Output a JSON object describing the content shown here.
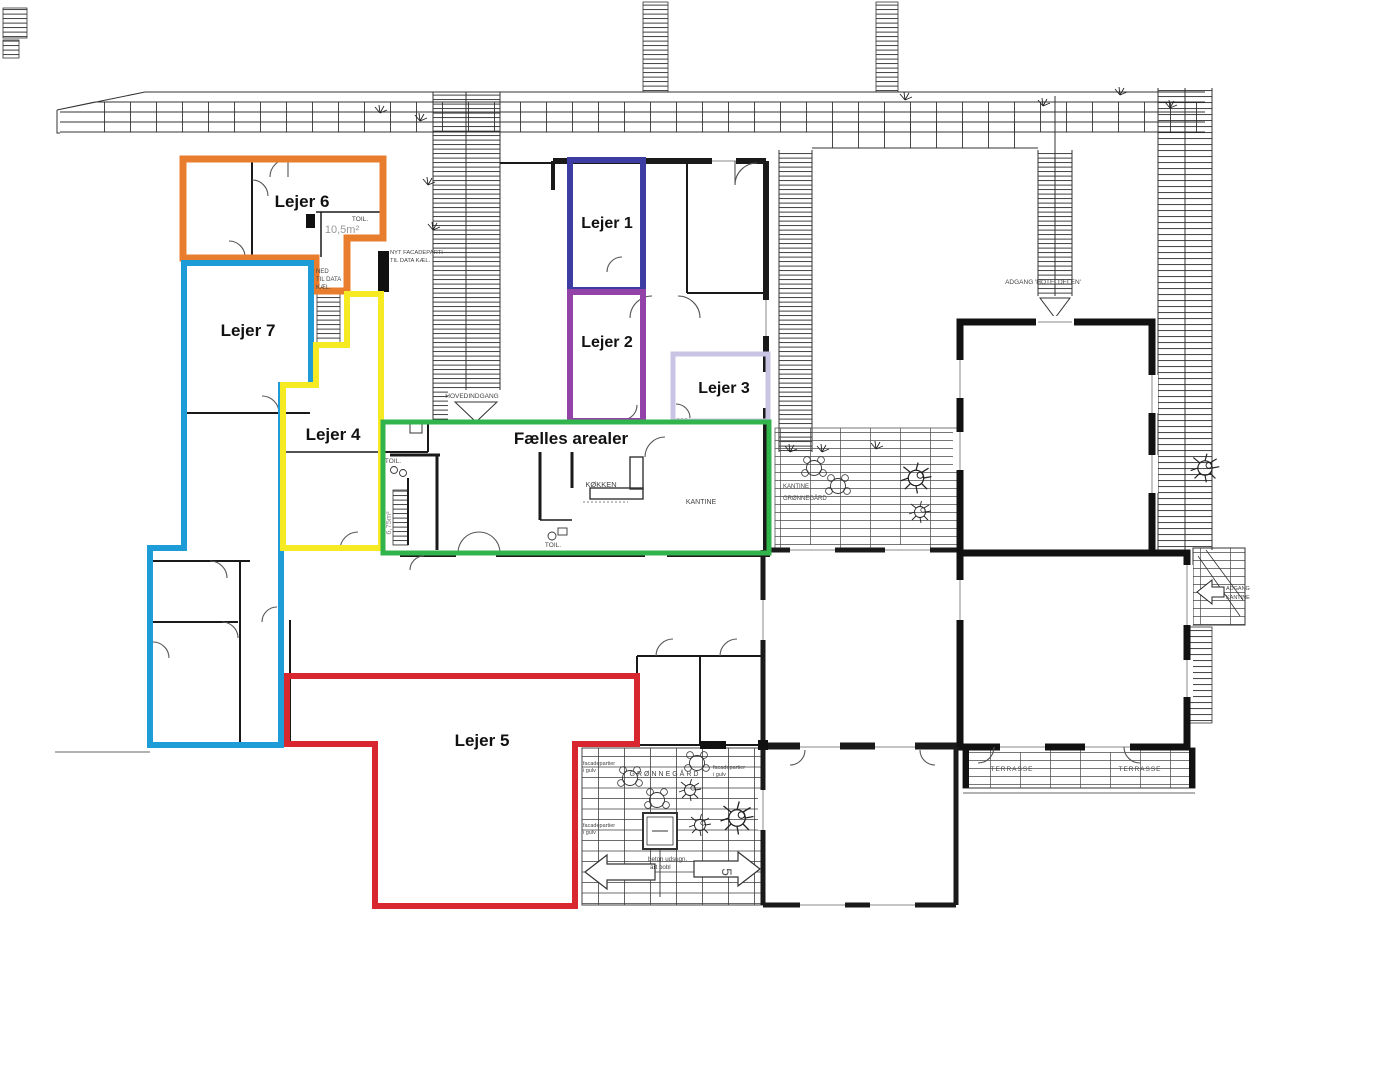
{
  "plan": {
    "type": "floor-plan",
    "tenants": [
      {
        "id": "lejer-1",
        "label": "Lejer 1",
        "color": "#3c3ca3"
      },
      {
        "id": "lejer-2",
        "label": "Lejer 2",
        "color": "#9343a7"
      },
      {
        "id": "lejer-3",
        "label": "Lejer 3",
        "color": "#c9c3e4"
      },
      {
        "id": "lejer-4",
        "label": "Lejer 4",
        "color": "#f6ea23"
      },
      {
        "id": "lejer-5",
        "label": "Lejer 5",
        "color": "#d8272e"
      },
      {
        "id": "lejer-6",
        "label": "Lejer 6",
        "color": "#e97d2e"
      },
      {
        "id": "lejer-7",
        "label": "Lejer 7",
        "color": "#1d9cd8"
      },
      {
        "id": "faelles-arealer",
        "label": "Fælles arealer",
        "color": "#31b44b"
      }
    ],
    "rooms": {
      "toilet_1": "TOIL.",
      "toilet_1_area": "10,5m²",
      "stair_down_l1": "NED",
      "stair_down_l2": "TIL DATA",
      "stair_down_l3": "KÆL.",
      "facade_note_l1": "NYT FACADEPARTI",
      "facade_note_l2": "TIL DATA KÆL.",
      "main_entrance": "HOVEDINDGANG",
      "toilet_2": "TOIL.",
      "stair_area": "6,75m²",
      "kitchen": "KØKKEN",
      "canteen": "KANTINE",
      "toilet_3": "TOIL.",
      "hotel_access": "ADGANG 'HOTELDELEN'",
      "canteen_yard_l1": "KANTINE",
      "canteen_yard_l2": "GRØNNEGÅRD",
      "courtyard": "GRØNNEGÅRD",
      "floor_glazing_l1": "facadepartier",
      "floor_glazing_l2": "i gulv",
      "concrete_l1": "beton udsugn.",
      "concrete_l2": "art bobl",
      "terrace_1": "TERRASSE",
      "terrace_2": "TERRASSE",
      "canteen_access_l1": "ADGANG",
      "canteen_access_l2": "KANTINE",
      "stair_number": "5"
    }
  }
}
